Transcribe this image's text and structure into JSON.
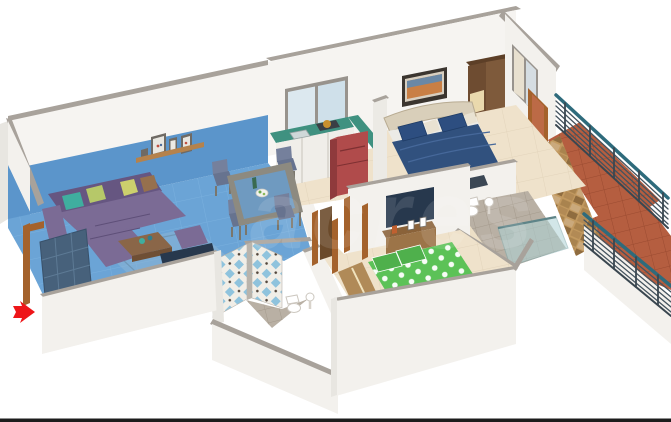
{
  "scene": {
    "type": "3d-isometric-floor-plan",
    "description": "Isometric 3D render of an apartment floor plan with living-dining zone highlighted in blue, kitchen, two bedrooms, two bathrooms and a balcony",
    "watermark": "acres"
  },
  "colors": {
    "wall_face": "#f6f4f1",
    "wall_cap": "#a8a29b",
    "floor": "#efe2cb",
    "highlight_floor": "#6ba4d6",
    "highlight_wall": "#5b95cb",
    "sofa": "#7b6b95",
    "sofa_dark": "#665681",
    "cushion_teal": "#3fae9f",
    "cushion_green": "#b6c869",
    "cushion_yellow": "#ccd06d",
    "cushion_brown": "#96704d",
    "rug": "#8fb6d4",
    "coffee_table": "#8a6648",
    "tv": "#27384d",
    "dining_wood": "#8d8a80",
    "dining_glass": "#6b9cc8",
    "chair": "#75809c",
    "counter": "#3f9180",
    "cabinet": "#f0eee9",
    "fridge": "#b04b4b",
    "bed_master": "#31517e",
    "pillow_blue": "#2d4e80",
    "headboard": "#d9cfba",
    "bed_second": "#5cc257",
    "bed_frame_wood": "#c8a272",
    "wood": "#9c7448",
    "ledge": "#b08a58",
    "door_frame": "#a4622c",
    "door_leaf": "#47617b",
    "tile_blue": "#8fc3dd",
    "bath_floor": "#b9b0a4",
    "stone": "#c2995f",
    "terracotta": "#b55e40",
    "railing": "#3c4a55",
    "railing_top": "#2e6b7c",
    "glass": "#aed3d6",
    "wardrobe": "#7e5a3b",
    "wardrobe_panel": "#ead9ad",
    "painting_frame": "#3b352f",
    "arrow": "#ee1518",
    "baseline": "#1c1c1c"
  },
  "rooms": [
    {
      "name": "living-dining",
      "highlighted": true,
      "items": [
        "l-shaped purple sofa with cushions",
        "coffee table with vases",
        "ottoman",
        "rug",
        "tv unit",
        "dining table with 4 chairs",
        "photo shelf",
        "entrance door"
      ]
    },
    {
      "name": "kitchen",
      "highlighted": false,
      "items": [
        "window",
        "green counter with sink",
        "gas stove",
        "white cabinets",
        "red refrigerator"
      ]
    },
    {
      "name": "master-bedroom",
      "highlighted": false,
      "items": [
        "blue double bed",
        "wall painting",
        "corner wardrobe",
        "window with curtain",
        "foot bench",
        "balcony door"
      ]
    },
    {
      "name": "second-bedroom",
      "highlighted": false,
      "items": [
        "green polka-dot double bed",
        "wall tv",
        "wooden tv cabinet",
        "wooden study ledge"
      ]
    },
    {
      "name": "bathroom-common",
      "highlighted": false,
      "items": [
        "blue diamond tiled walls",
        "toilet",
        "washbasin"
      ]
    },
    {
      "name": "bathroom-attached",
      "highlighted": false,
      "items": [
        "glass shower",
        "toilet",
        "washbasin"
      ]
    },
    {
      "name": "balcony",
      "highlighted": false,
      "items": [
        "metal railing with teal top rail",
        "stone clad wall",
        "terracotta tile floor"
      ]
    }
  ],
  "annotations": {
    "entrance_arrow": "red arrow pointing right at the entrance",
    "bottom_rule": "black horizontal line along bottom edge"
  }
}
